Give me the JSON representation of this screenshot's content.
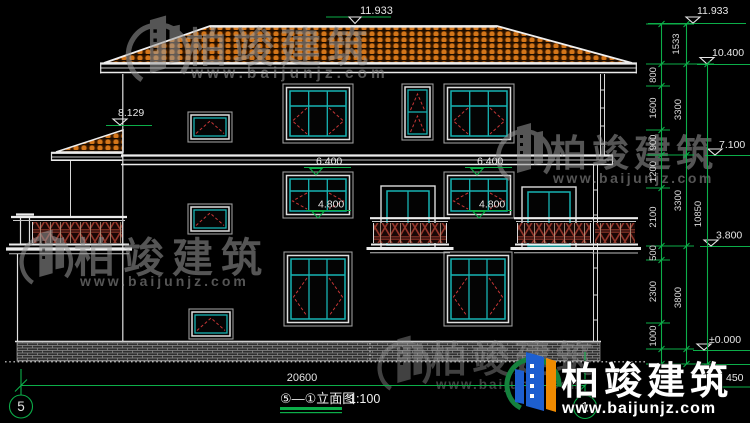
{
  "watermark": {
    "brand": "柏竣建筑",
    "url": "www.baijunjz.com"
  },
  "title_block": {
    "drawing_name": "⑤—①立面图",
    "scale": "1:100"
  },
  "axes": {
    "left_bubble": "5",
    "right_bubble": "1"
  },
  "elevations": {
    "ridge": "11.933",
    "ridge_right": "11.933",
    "eave": "10.400",
    "porch_eave": "8.129",
    "level_3f": "7.100",
    "window_head_left": "6.400",
    "window_head_right": "6.400",
    "window_sill_left": "4.800",
    "window_sill_right": "4.800",
    "level_2f": "3.800",
    "ground": "±0.000",
    "plinth_drop": "450"
  },
  "dim_chain_segments": [
    "1533",
    "800",
    "1600",
    "900",
    "1200",
    "2100",
    "500",
    "2300",
    "1000"
  ],
  "dim_chain_storeys": [
    "3300",
    "3300",
    "3800"
  ],
  "dim_total_height": "10850",
  "dim_overall_width": "20600",
  "colors": {
    "background": "#000000",
    "line_green": "#0cae49",
    "glass_cyan": "#17b3b3",
    "tile_orange": "#d4761a",
    "swing_red": "#c63636",
    "railing_red": "#93362a",
    "outline_white": "#ececec",
    "frame_gray": "#9a9a9a",
    "logo_blue": "#1d5fd0",
    "logo_orange": "#ef8a00",
    "logo_green": "#15813d",
    "watermark_gray": "#9b9b9b"
  }
}
